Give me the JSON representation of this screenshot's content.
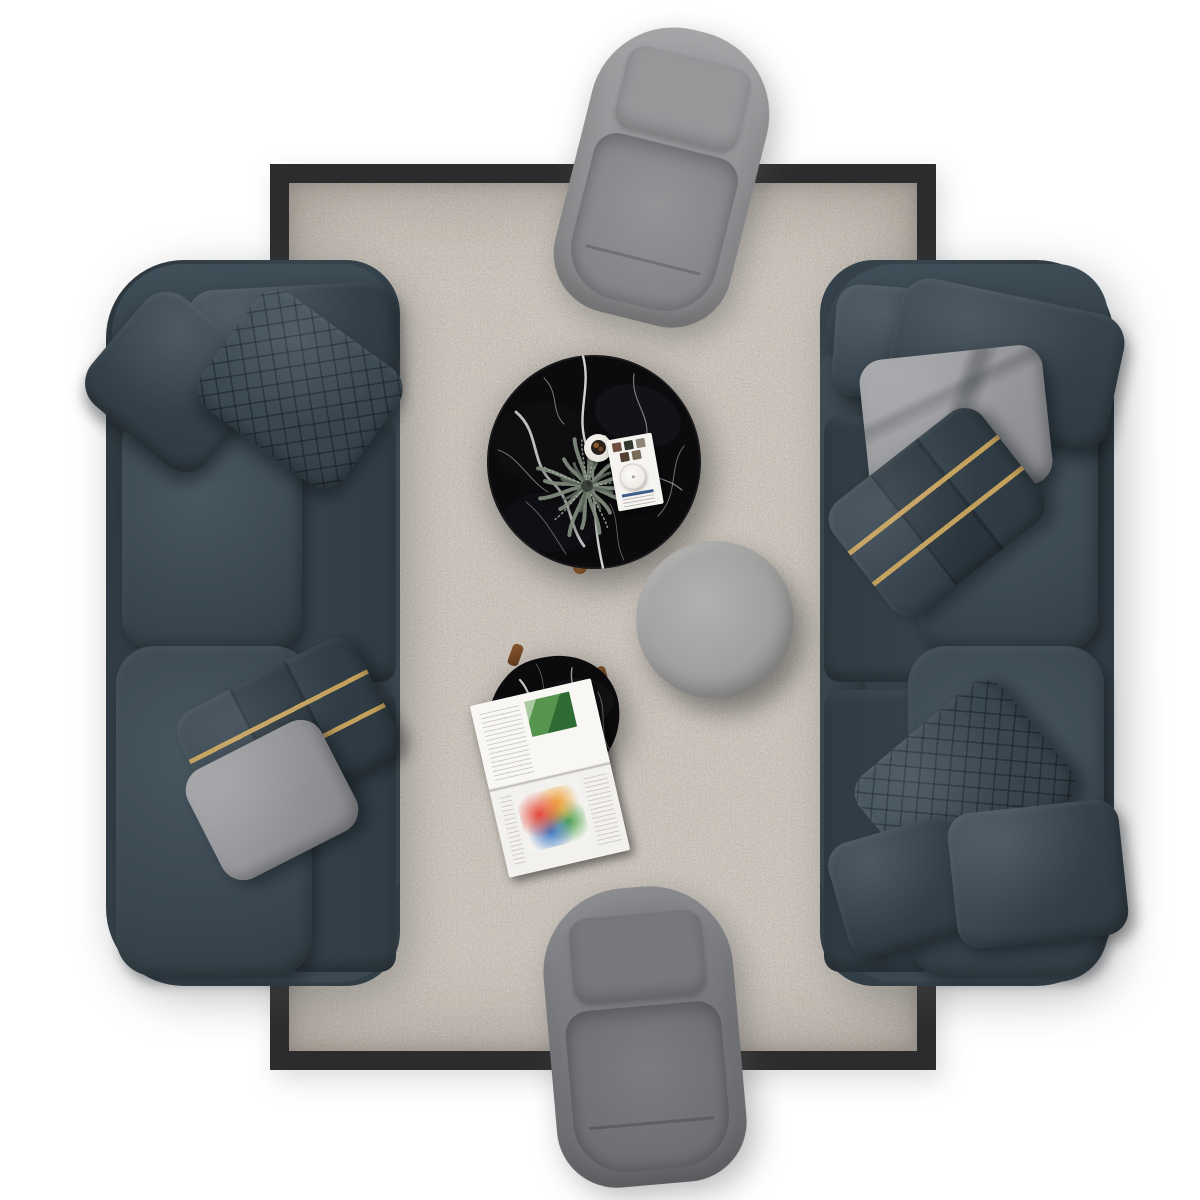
{
  "scene": {
    "type": "furniture-set-top-down-render",
    "setting": "living room arrangement photographed from directly above on a white floor",
    "items": [
      {
        "name": "area-rug",
        "shape": "rectangle",
        "field_color": "#978e85",
        "border_color": "#2c2c2e",
        "texture": "mottled boucle weave"
      },
      {
        "name": "sofa-left",
        "orientation": "vertical, facing right toward center",
        "upholstery_color": "#36424b",
        "material": "velvet",
        "pillows": [
          "dark-velvet-lumbar",
          "dark-velvet-throw",
          "diamond-quilted-velvet",
          "gold-stripe-band-velvet",
          "gray-velvet"
        ]
      },
      {
        "name": "sofa-right",
        "orientation": "vertical, facing left toward center",
        "upholstery_color": "#36424b",
        "material": "velvet",
        "pillows": [
          "dark-velvet-lumbar",
          "dark-velvet-large",
          "gray-velvet-folded",
          "gold-stripe-band-velvet",
          "diamond-quilted-velvet",
          "dark-velvet-small",
          "dark-velvet-throw"
        ]
      },
      {
        "name": "armchair-top",
        "orientation": "backrest up, slightly rotated clockwise",
        "upholstery_color": "#9b9b9e",
        "material": "velvet"
      },
      {
        "name": "armchair-bottom",
        "orientation": "backrest up, slightly rotated counterclockwise",
        "upholstery_color": "#7b7b7f",
        "material": "velvet"
      },
      {
        "name": "coffee-table-large",
        "shape": "round",
        "top_material": "black marble with white veining",
        "top_color": "#0b0b0d",
        "decor": [
          "green-feathery-plant",
          "white-cup-with-potpourri",
          "white-card-with-photos",
          "white-candle"
        ],
        "leg_color": "#8a4f22"
      },
      {
        "name": "coffee-table-small",
        "shape": "organic round",
        "top_material": "black marble with white veining",
        "top_color": "#0b0b0d",
        "decor": [
          "open-magazine-with-green-photo-and-colorful-print"
        ],
        "leg_color": "#7b4a26"
      },
      {
        "name": "round-pouf",
        "shape": "cylinder",
        "upholstery_color": "#a5a6a4",
        "material": "velvet"
      }
    ]
  },
  "palette": {
    "rug_field": "#978e85",
    "rug_border": "#2c2c2e",
    "sofa": "#36424b",
    "sofa_deep": "#2b353d",
    "pillow_gray": "#95969a",
    "gold": "#c3a05c",
    "chair_light": "#9b9b9e",
    "chair_dark": "#7b7b7f",
    "pouf": "#a5a6a4",
    "marble": "#0b0b0d",
    "paper": "#f5f4f1",
    "wood": "#7b4a26",
    "plant": "#828d7e"
  }
}
